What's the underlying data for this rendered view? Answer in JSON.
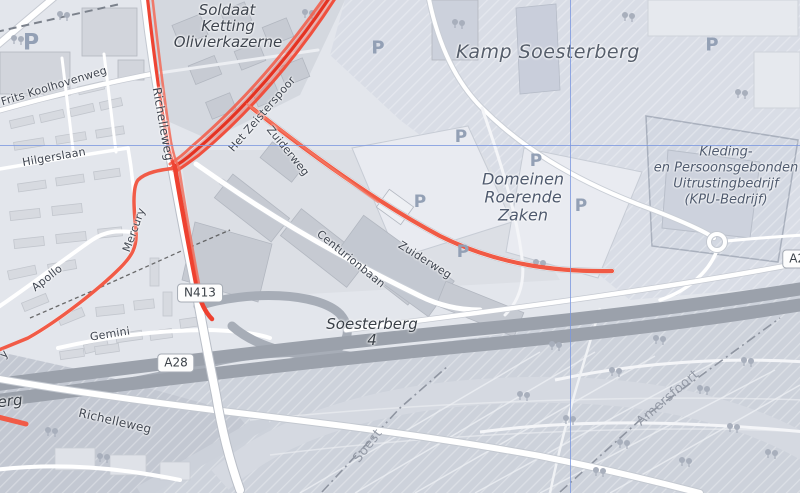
{
  "map": {
    "view": "openstreetmap",
    "place_labels": {
      "soldaat_line1": "Soldaat",
      "soldaat_line2": "Ketting",
      "soldaat_line3": "Olivierkazerne",
      "kamp": "Kamp Soesterberg",
      "domeinen_line1": "Domeinen",
      "domeinen_line2": "Roerende",
      "domeinen_line3": "Zaken",
      "kpu_line1": "Kleding-",
      "kpu_line2": "en Persoonsgebonden",
      "kpu_line3": "Uitrustingbedrijf",
      "kpu_line4": "(KPU-Bedrijf)"
    },
    "street_labels": {
      "frits_koolhovenweg": "Frits Koolhovenweg",
      "hilgerslaan": "Hilgerslaan",
      "richelleweg_north": "Richelleweg",
      "richelleweg_south": "Richelleweg",
      "mercury": "Mercury",
      "apollo": "Apollo",
      "gemini": "Gemini",
      "centurionbaan": "Centurionbaan",
      "zuiderweg_upper": "Zuiderweg",
      "zuiderweg_lower": "Zuiderweg",
      "het_zeisterspoor": "Het Zeisterspoor",
      "edge_fragment_erg": "erg",
      "edge_fragment_y": "y"
    },
    "boundary_labels": {
      "amersfoort": "Amersfoort",
      "soest": "Soest"
    },
    "road_badges": {
      "n413": "N413",
      "a28": "A28",
      "a28_right_edge": "A28"
    },
    "motorway_exit": {
      "name": "Soesterberg",
      "number": "4"
    },
    "parking_label": "P",
    "colors": {
      "route_overlay": "#f04a38",
      "crosshair": "#7b97e0",
      "motorway_fill": "#9ba1ab",
      "street_label": "#3f4550",
      "place_label": "#4f5a6e",
      "boundary_label": "#949aa6",
      "parking_icon": "#93a0b5"
    }
  }
}
